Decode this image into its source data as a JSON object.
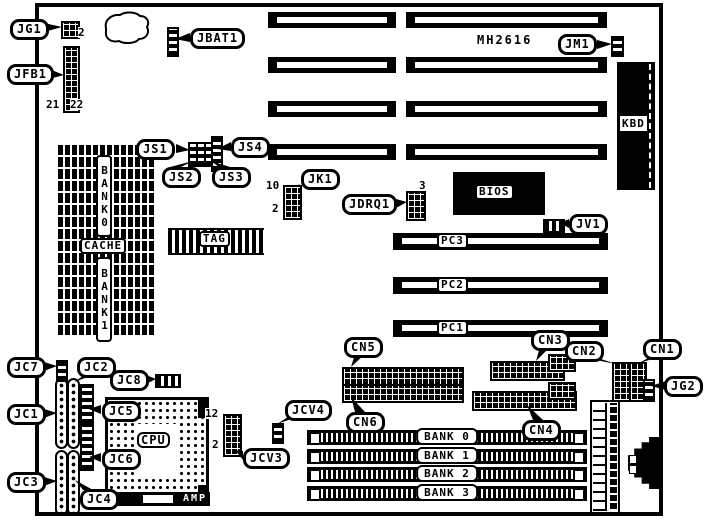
{
  "diagram": {
    "type": "motherboard-layout",
    "colors": {
      "ink": "#000000",
      "paper": "#ffffff"
    },
    "chip_marking": "MH2616",
    "jumper_labels": {
      "jg1": "JG1",
      "jfb1": "JFB1",
      "jbat1": "JBAT1",
      "jm1": "JM1",
      "js1": "JS1",
      "js2": "JS2",
      "js3": "JS3",
      "js4": "JS4",
      "jk1": "JK1",
      "jdrq1": "JDRQ1",
      "jv1": "JV1",
      "cn1": "CN1",
      "cn2": "CN2",
      "cn3": "CN3",
      "cn4": "CN4",
      "cn5": "CN5",
      "cn6": "CN6",
      "jg2": "JG2",
      "jc1": "JC1",
      "jc2": "JC2",
      "jc3": "JC3",
      "jc4": "JC4",
      "jc5": "JC5",
      "jc6": "JC6",
      "jc7": "JC7",
      "jc8": "JC8",
      "jcv3": "JCV3",
      "jcv4": "JCV4"
    },
    "component_labels": {
      "kbd": "KBD",
      "bios": "BIOS",
      "pc1": "PC1",
      "pc2": "PC2",
      "pc3": "PC3",
      "tag": "TAG",
      "cache": "CACHE",
      "cache_bank0": "BANK0",
      "cache_bank1": "BANK1",
      "cpu": "CPU",
      "amp": "AMP",
      "simm_banks": [
        "BANK 0",
        "BANK 1",
        "BANK 2",
        "BANK 3"
      ]
    },
    "pin_numbers": {
      "jg1_pin2": "2",
      "jfb1_pin21": "21",
      "jfb1_pin22": "22",
      "jk1_pin10": "10",
      "jk1_pin2": "2",
      "jdrq1_pin3": "3",
      "jcv3_pin12": "12",
      "jcv3_pin2": "2"
    }
  }
}
